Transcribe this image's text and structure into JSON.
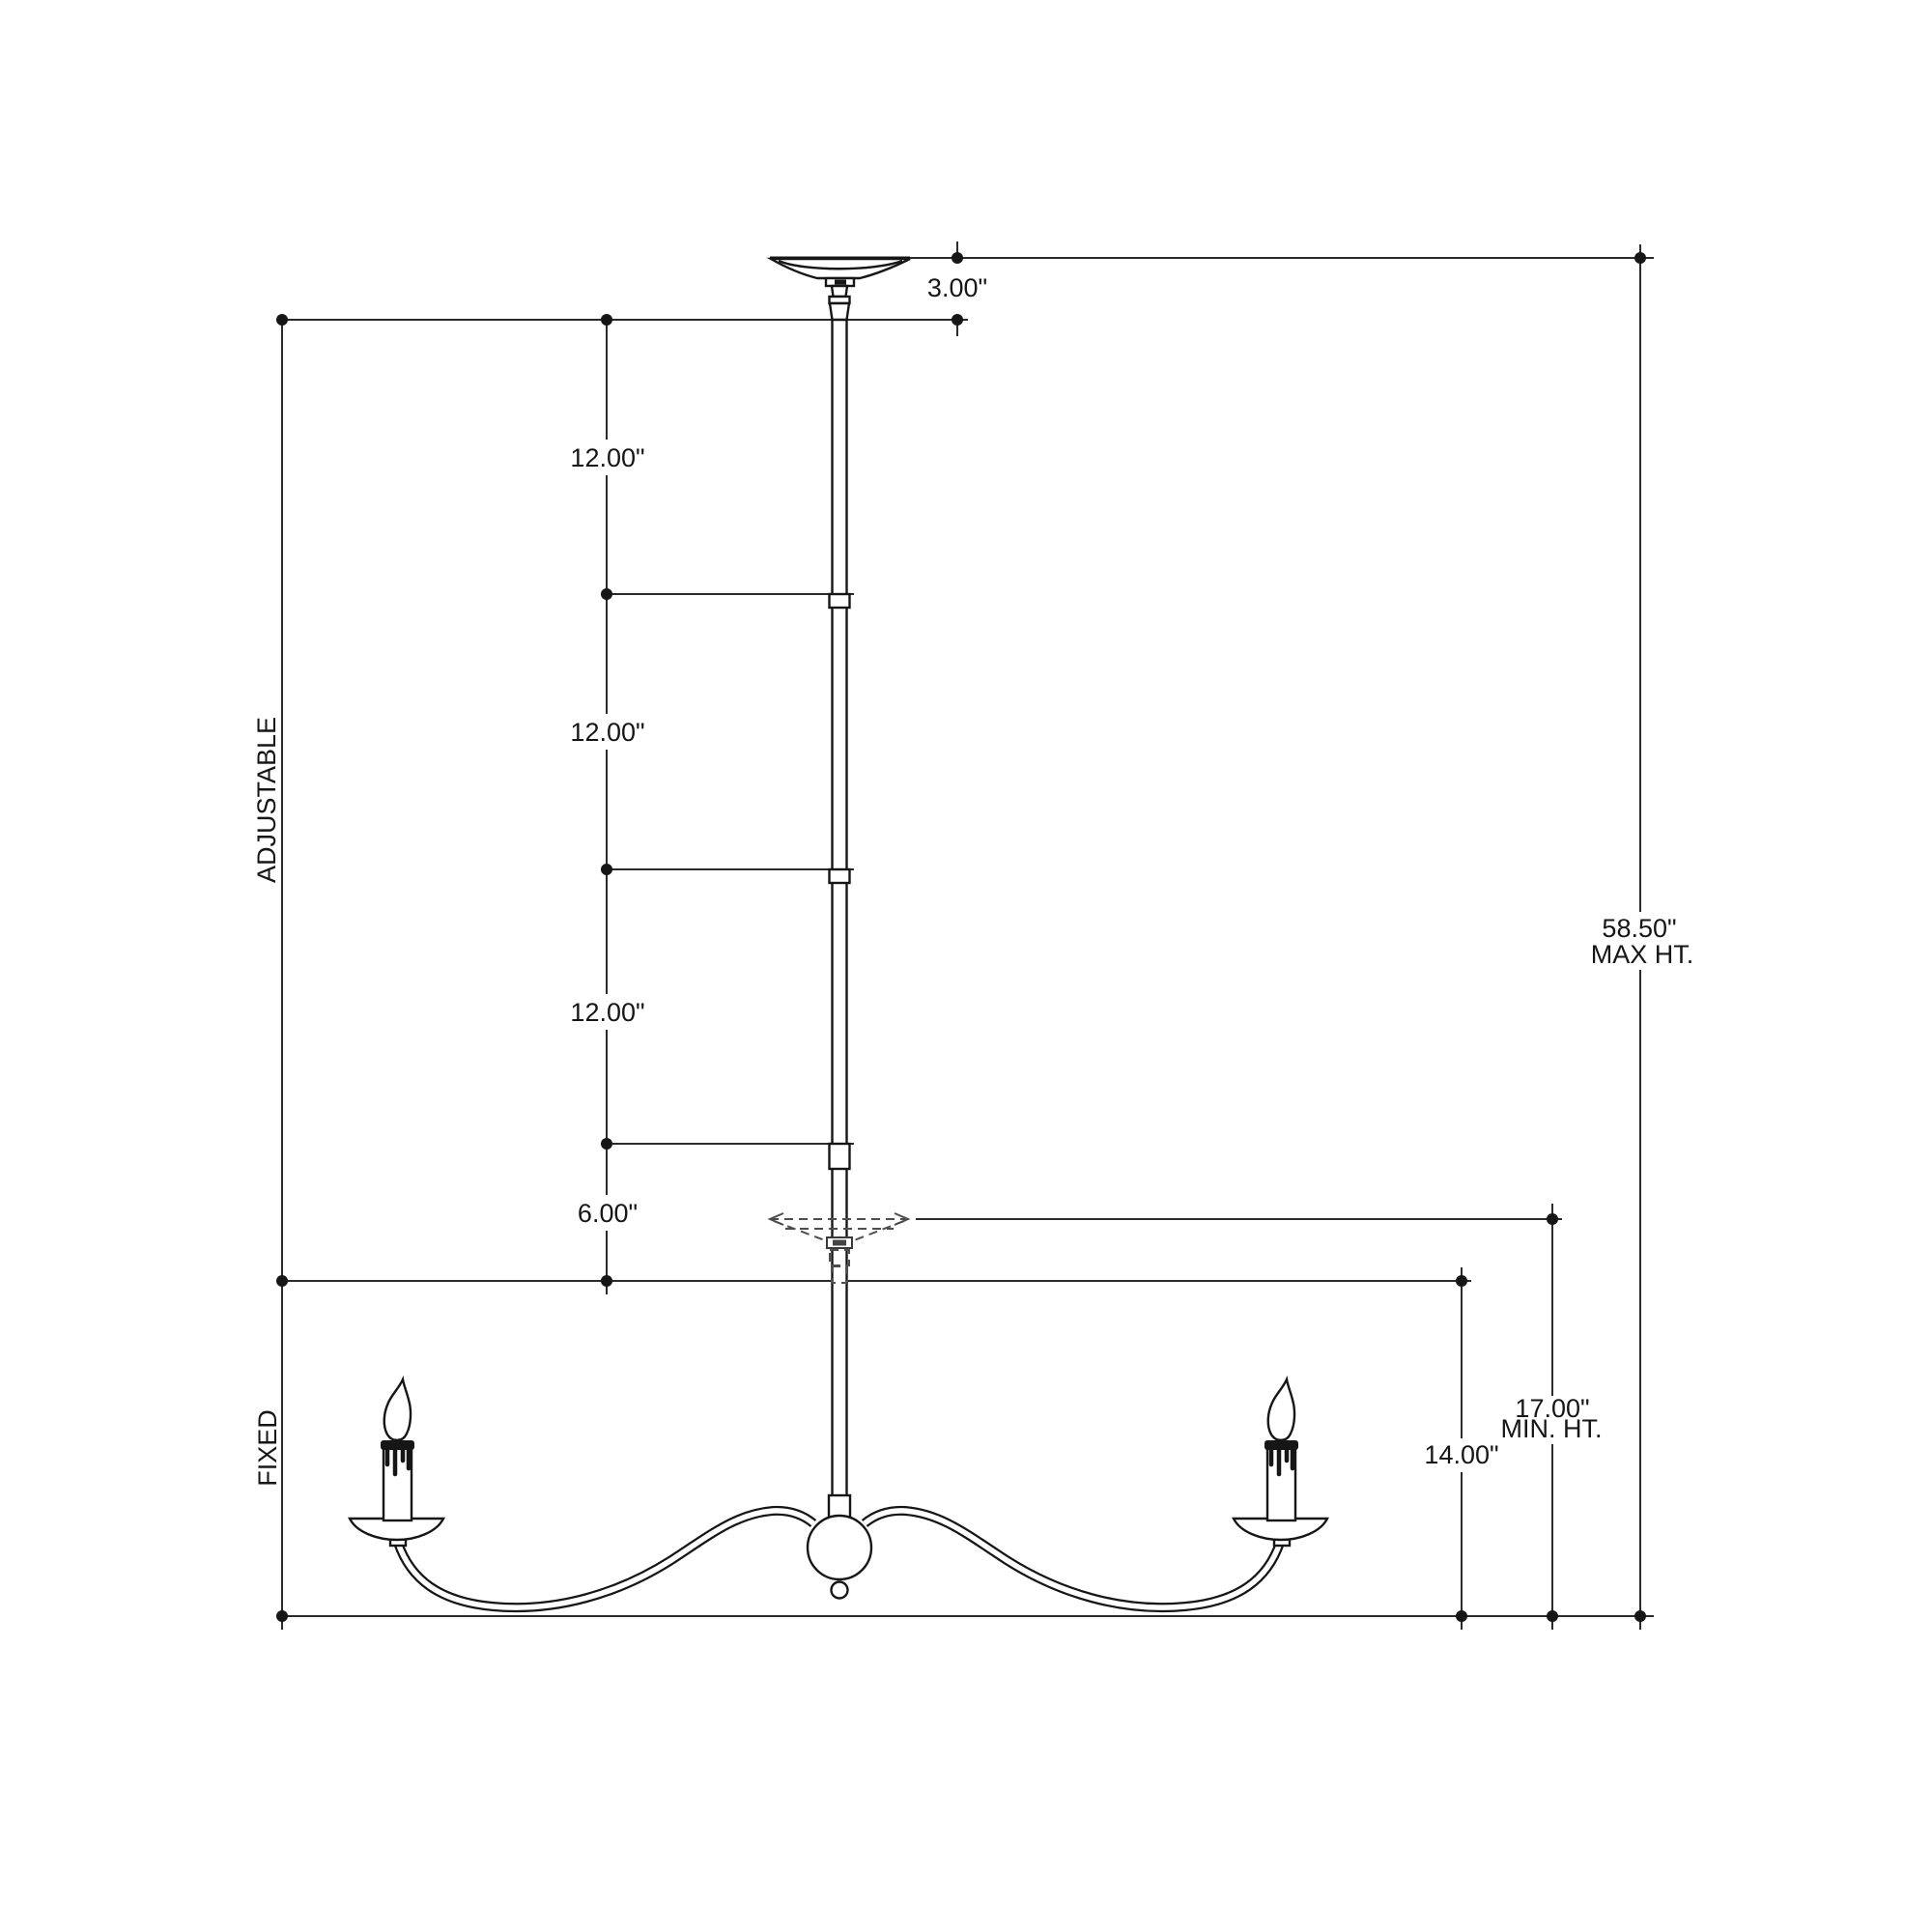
{
  "drawing": {
    "type": "two-arm linear chandelier dimension drawing",
    "background": "#ffffff",
    "line_color": "#2b2b2b",
    "sections": {
      "adjustable": "ADJUSTABLE",
      "fixed": "FIXED"
    },
    "labels": {
      "canopy_height": "3.00\"",
      "segment_1": "12.00\"",
      "segment_2": "12.00\"",
      "segment_3": "12.00\"",
      "segment_4": "6.00\"",
      "max_height_value": "58.50\"",
      "max_height_suffix": "MAX HT.",
      "min_height_value": "17.00\"",
      "min_height_suffix": "MIN. HT.",
      "fixture_height": "14.00\""
    },
    "stem": {
      "adjustable_segments": [
        "12.00\"",
        "12.00\"",
        "12.00\"",
        "6.00\""
      ],
      "canopy_height_in": 3.0,
      "fixed_fixture_height_in": 14.0,
      "min_overall_height_in": 17.0,
      "max_overall_height_in": 58.5
    },
    "fixture": {
      "arm_count": 2,
      "candle_count": 2
    }
  }
}
